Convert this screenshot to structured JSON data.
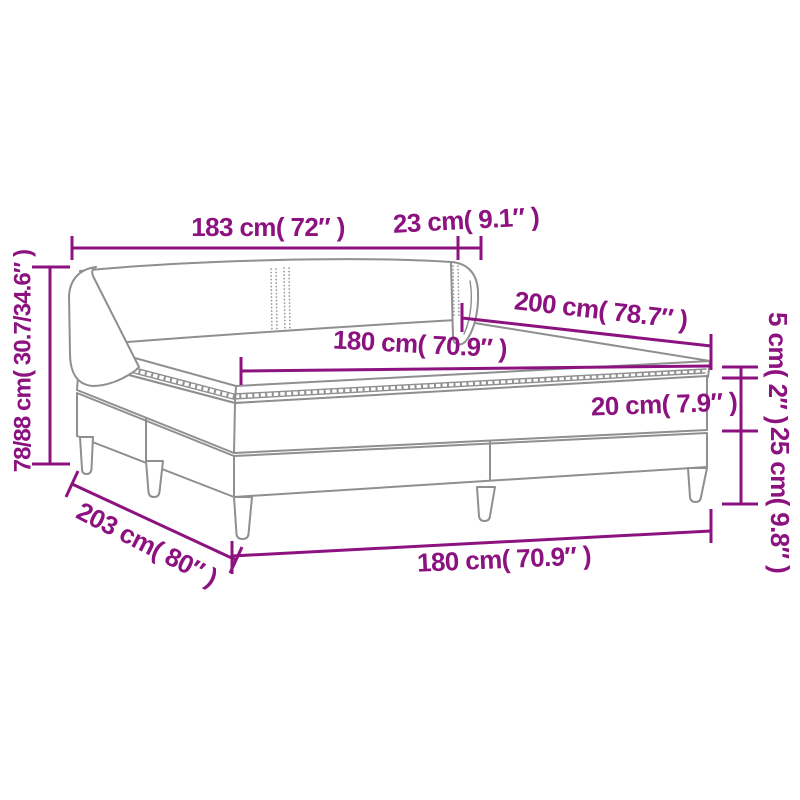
{
  "figure": {
    "type": "product-dimension-diagram",
    "product": "box-spring-bed-with-mattress",
    "colors": {
      "dimension": "#8C1280",
      "outline": "#8f8f8f",
      "background": "#ffffff"
    },
    "labels": {
      "headboard_width": "183 cm( 72″ )",
      "headboard_side_depth": "23 cm( 9.1″ )",
      "bed_length": "200 cm( 78.7″ )",
      "mattress_width": "180 cm( 70.9″ )",
      "topper_thickness": "5 cm( 2″ )",
      "mattress_thickness": "20 cm( 7.9″ )",
      "base_height": "25 cm( 9.8″ )",
      "overall_height": "78/88 cm( 30.7/34.6″ )",
      "base_length": "203 cm( 80″ )",
      "base_width": "180 cm( 70.9″ )"
    }
  }
}
